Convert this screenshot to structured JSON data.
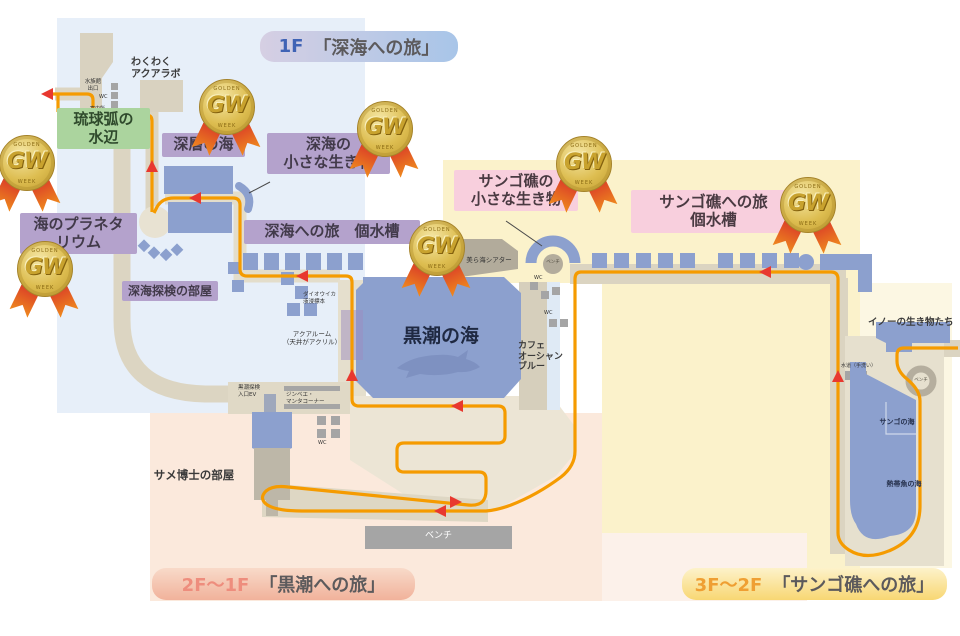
{
  "titles": {
    "f1": {
      "floor": "1F",
      "name": "「深海への旅」"
    },
    "f2": {
      "floor": "2F〜1F",
      "name": "「黒潮への旅」"
    },
    "f3": {
      "floor": "3F〜2F",
      "name": "「サンゴ礁への旅」"
    }
  },
  "medal": {
    "text": "GW",
    "arc_top": "GOLDEN",
    "arc_bottom": "WEEK",
    "count": 7
  },
  "labels": {
    "f1": {
      "wakuwaku_aqualab": "わくわく\nアクアラボ",
      "aquarium_exit": "水族館\n出口",
      "wc": "WC",
      "information": "案内所",
      "ryukyu_water_edge": "琉球弧の\n水辺",
      "deep_layer_sea": "深層の海",
      "deep_sea_small_creatures": "深海の\n小さな生き物",
      "ocean_planetarium": "海のプラネタ\nリウム",
      "deep_sea_tanks": "深海への旅　個水槽",
      "deep_sea_exploration_room": "深海探検の部屋",
      "giant_squid_specimen": "ダイオウイカ\n液浸標本",
      "aqua_room": "アクアルーム\n（天井がアクリル）"
    },
    "f2": {
      "kuroshio_sea": "黒潮の海",
      "kuroshio_ev": "黒潮探検\n入口EV",
      "whaleshark_manta_corner": "ジンベエ・\nマンタコーナー",
      "shark_doctor_room": "サメ博士の部屋",
      "cafe_ocean_blue": "カフェ\nオーシャン\nブルー",
      "bench": "ベンチ"
    },
    "f3": {
      "churaumi_theater": "美ら海シアター",
      "coral_small_creatures": "サンゴ礁の\n小さな生き物",
      "coral_journey_tanks": "サンゴ礁への旅\n個水槽",
      "ino_creatures": "イノーの生き物たち",
      "water_tap": "水道（手洗い）",
      "coral_sea": "サンゴの海",
      "tropical_fish_sea": "熱帯魚の海",
      "bench": "ベンチ"
    }
  },
  "colors": {
    "region_1f": "#e7eff9",
    "region_2f": "#fbe9dc",
    "region_3f": "#fbf2cb",
    "region_3f_right": "#fcf7e3",
    "tank_blue": "#8ca0ce",
    "route_orange": "#f59b00",
    "arrow_red": "#e8382f",
    "walkway_beige": "#dcd5c2",
    "label_purple": "#b4a2cc",
    "label_green": "#abd49e",
    "label_pink": "#f8cfdd"
  }
}
